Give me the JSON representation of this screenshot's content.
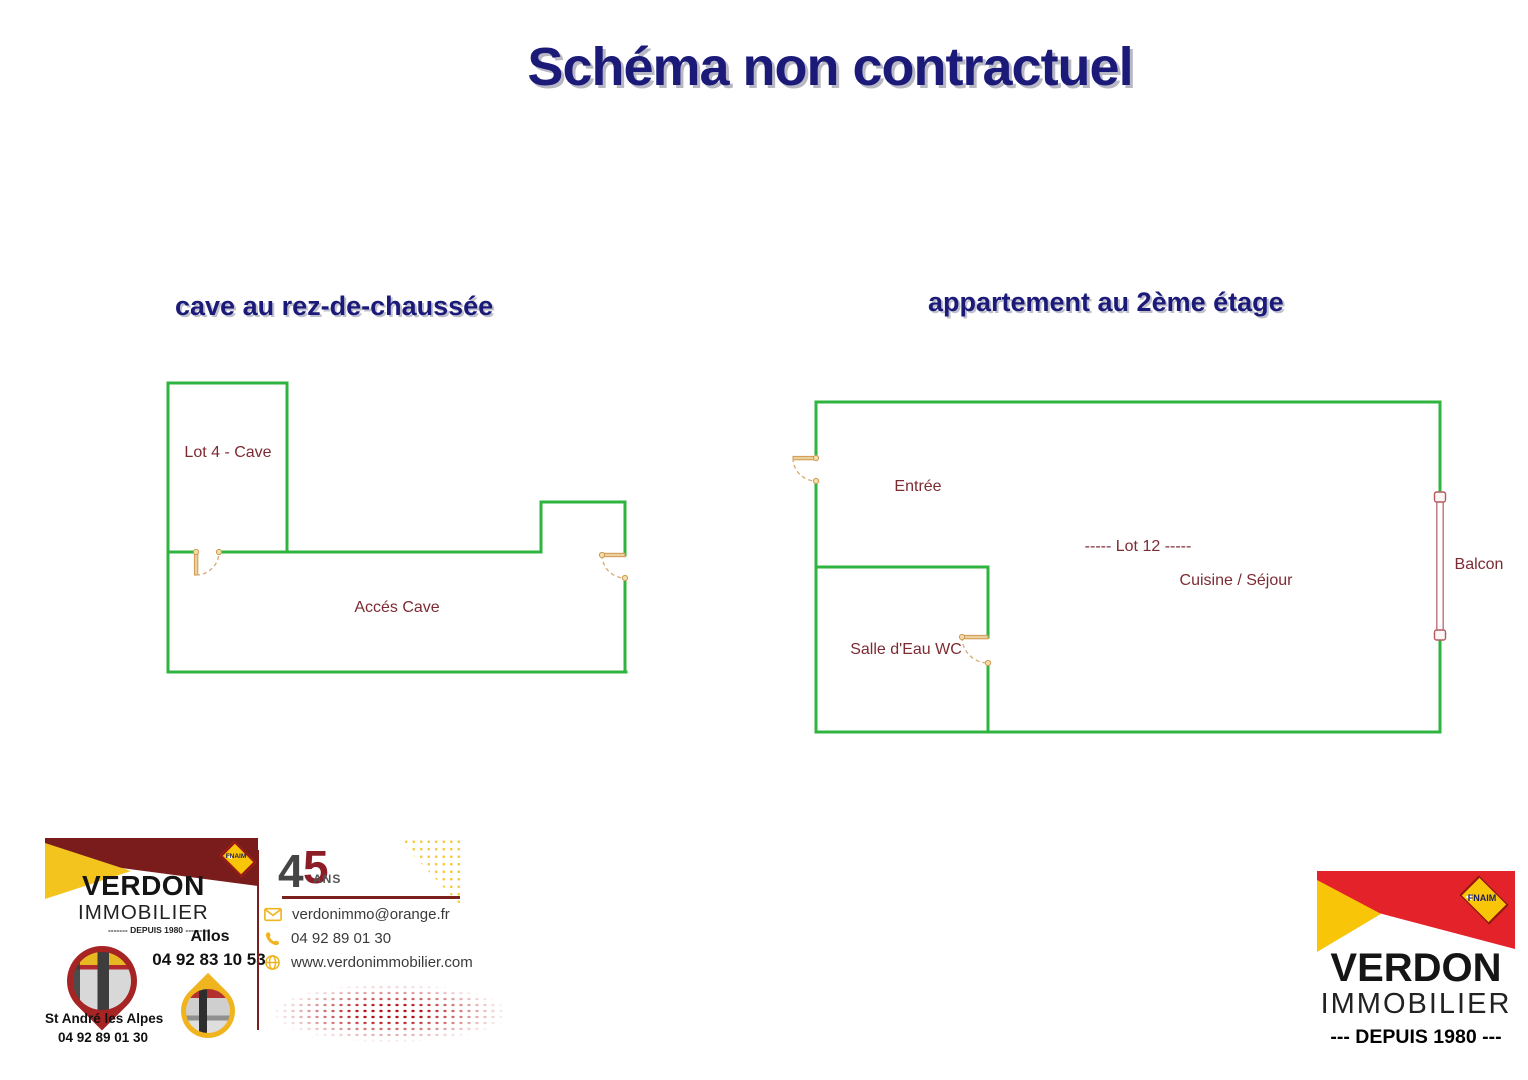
{
  "title": "Schéma non contractuel",
  "plans": {
    "cave": {
      "heading": "cave au rez-de-chaussée",
      "labels": {
        "lot4": "Lot 4 - Cave",
        "acces": "Accés Cave"
      }
    },
    "apartment": {
      "heading": "appartement au 2ème étage",
      "labels": {
        "entree": "Entrée",
        "lot12": "-----  Lot 12  -----",
        "cuisine": "Cuisine / Séjour",
        "salle_eau": "Salle d'Eau WC",
        "balcon": "Balcon"
      }
    }
  },
  "agency_card": {
    "brand_line1": "VERDON",
    "brand_line2": "IMMOBILIER",
    "since_line": "-------  DEPUIS 1980  --------",
    "fnaim_label": "FNAIM",
    "anniversary": {
      "digit4": "4",
      "digit5": "5",
      "ans": "ANS"
    },
    "office_allos": {
      "city": "Allos",
      "phone": "04 92 83 10 53"
    },
    "office_standre": {
      "city": "St André les Alpes",
      "phone": "04 92 89 01 30"
    },
    "contacts": [
      {
        "icon": "envelope-icon",
        "text": "verdonimmo@orange.fr"
      },
      {
        "icon": "phone-icon",
        "text": "04 92 89 01 30"
      },
      {
        "icon": "globe-icon",
        "text": "www.verdonimmobilier.com"
      }
    ]
  },
  "corner_logo": {
    "brand_line1": "VERDON",
    "brand_line2": "IMMOBILIER",
    "since_line": "--- DEPUIS 1980 ---",
    "fnaim_label": "FNAIM"
  },
  "colors": {
    "title_navy": "#1b1a78",
    "wall_green": "#2fb43f",
    "label_maroon": "#7d2b33",
    "door_tan": "#d8a55e",
    "balcony_pink": "#c2858d",
    "brand_maroon": "#7a1c1c",
    "brand_red": "#e4222a",
    "brand_yellow": "#f2c41d"
  }
}
